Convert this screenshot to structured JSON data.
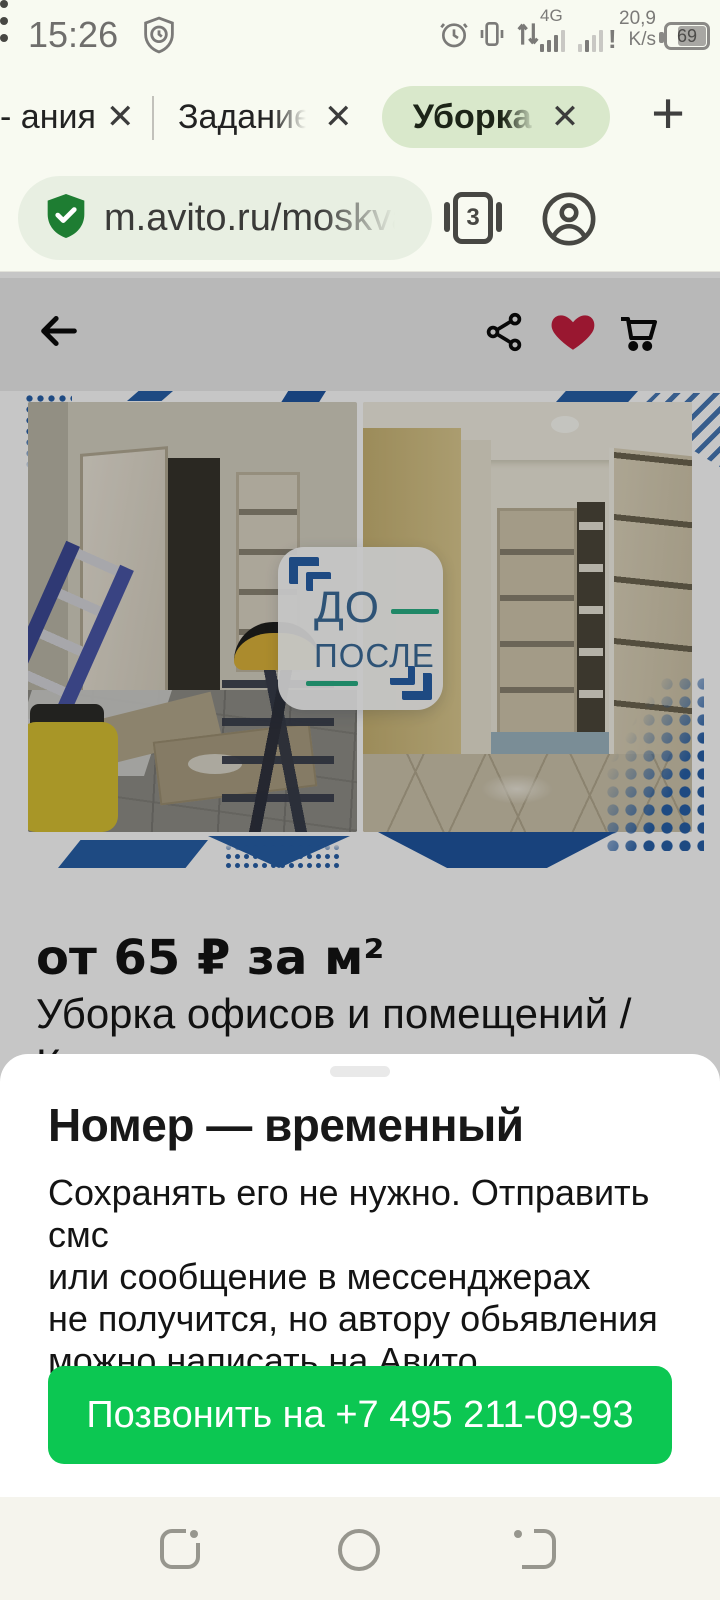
{
  "status_bar": {
    "time": "15:26",
    "network_type": "4G",
    "network_alert": "!",
    "speed_value": "20,9",
    "speed_unit": "K/s",
    "battery_level": "69"
  },
  "tab_bar": {
    "tabs": [
      {
        "label": "ания -",
        "active": false
      },
      {
        "label": "Задание М",
        "active": false
      },
      {
        "label": "Уборка оф",
        "active": true
      }
    ],
    "close_glyph": "✕",
    "new_tab_glyph": "+"
  },
  "url_bar": {
    "url": "m.avito.ru/moskva",
    "tab_count": "3"
  },
  "listing": {
    "price": "от 65 ₽ за м²",
    "title": "Уборка офисов и помещений /",
    "title_overflow": "К",
    "badge_before": "ДО",
    "badge_after": "ПОСЛЕ"
  },
  "sheet": {
    "title": "Номер — временный",
    "body_lines": [
      "Сохранять его не нужно. Отправить смс",
      "или сообщение в мессенджерах",
      "не получится, но автору обьявления",
      "можно написать на Авито."
    ],
    "call_button": "Позвонить на +7 495 211-09-93"
  },
  "icons": {
    "status": [
      "shield-clock-icon",
      "alarm-icon",
      "vibrate-icon",
      "data-arrows-icon",
      "signal-bars-icon",
      "battery-icon"
    ],
    "url_row": [
      "shield-secure-icon",
      "tab-count-icon",
      "profile-icon",
      "overflow-menu-icon"
    ],
    "page_header": [
      "back-arrow-icon",
      "share-icon",
      "heart-icon",
      "cart-icon"
    ],
    "navbar": [
      "recents-icon",
      "home-icon",
      "back-icon"
    ]
  },
  "colors": {
    "accent_green": "#0cc752",
    "banner_blue": "#2760a8",
    "badge_text_blue": "#3c6b99",
    "badge_green": "#2aaf85",
    "heart_red": "#c51e3e",
    "shield_green": "#1e7d32",
    "tab_active_bg": "#d9e8cb",
    "chrome_bg": "#f8faf1",
    "navbar_bg": "#f5f4ed"
  }
}
